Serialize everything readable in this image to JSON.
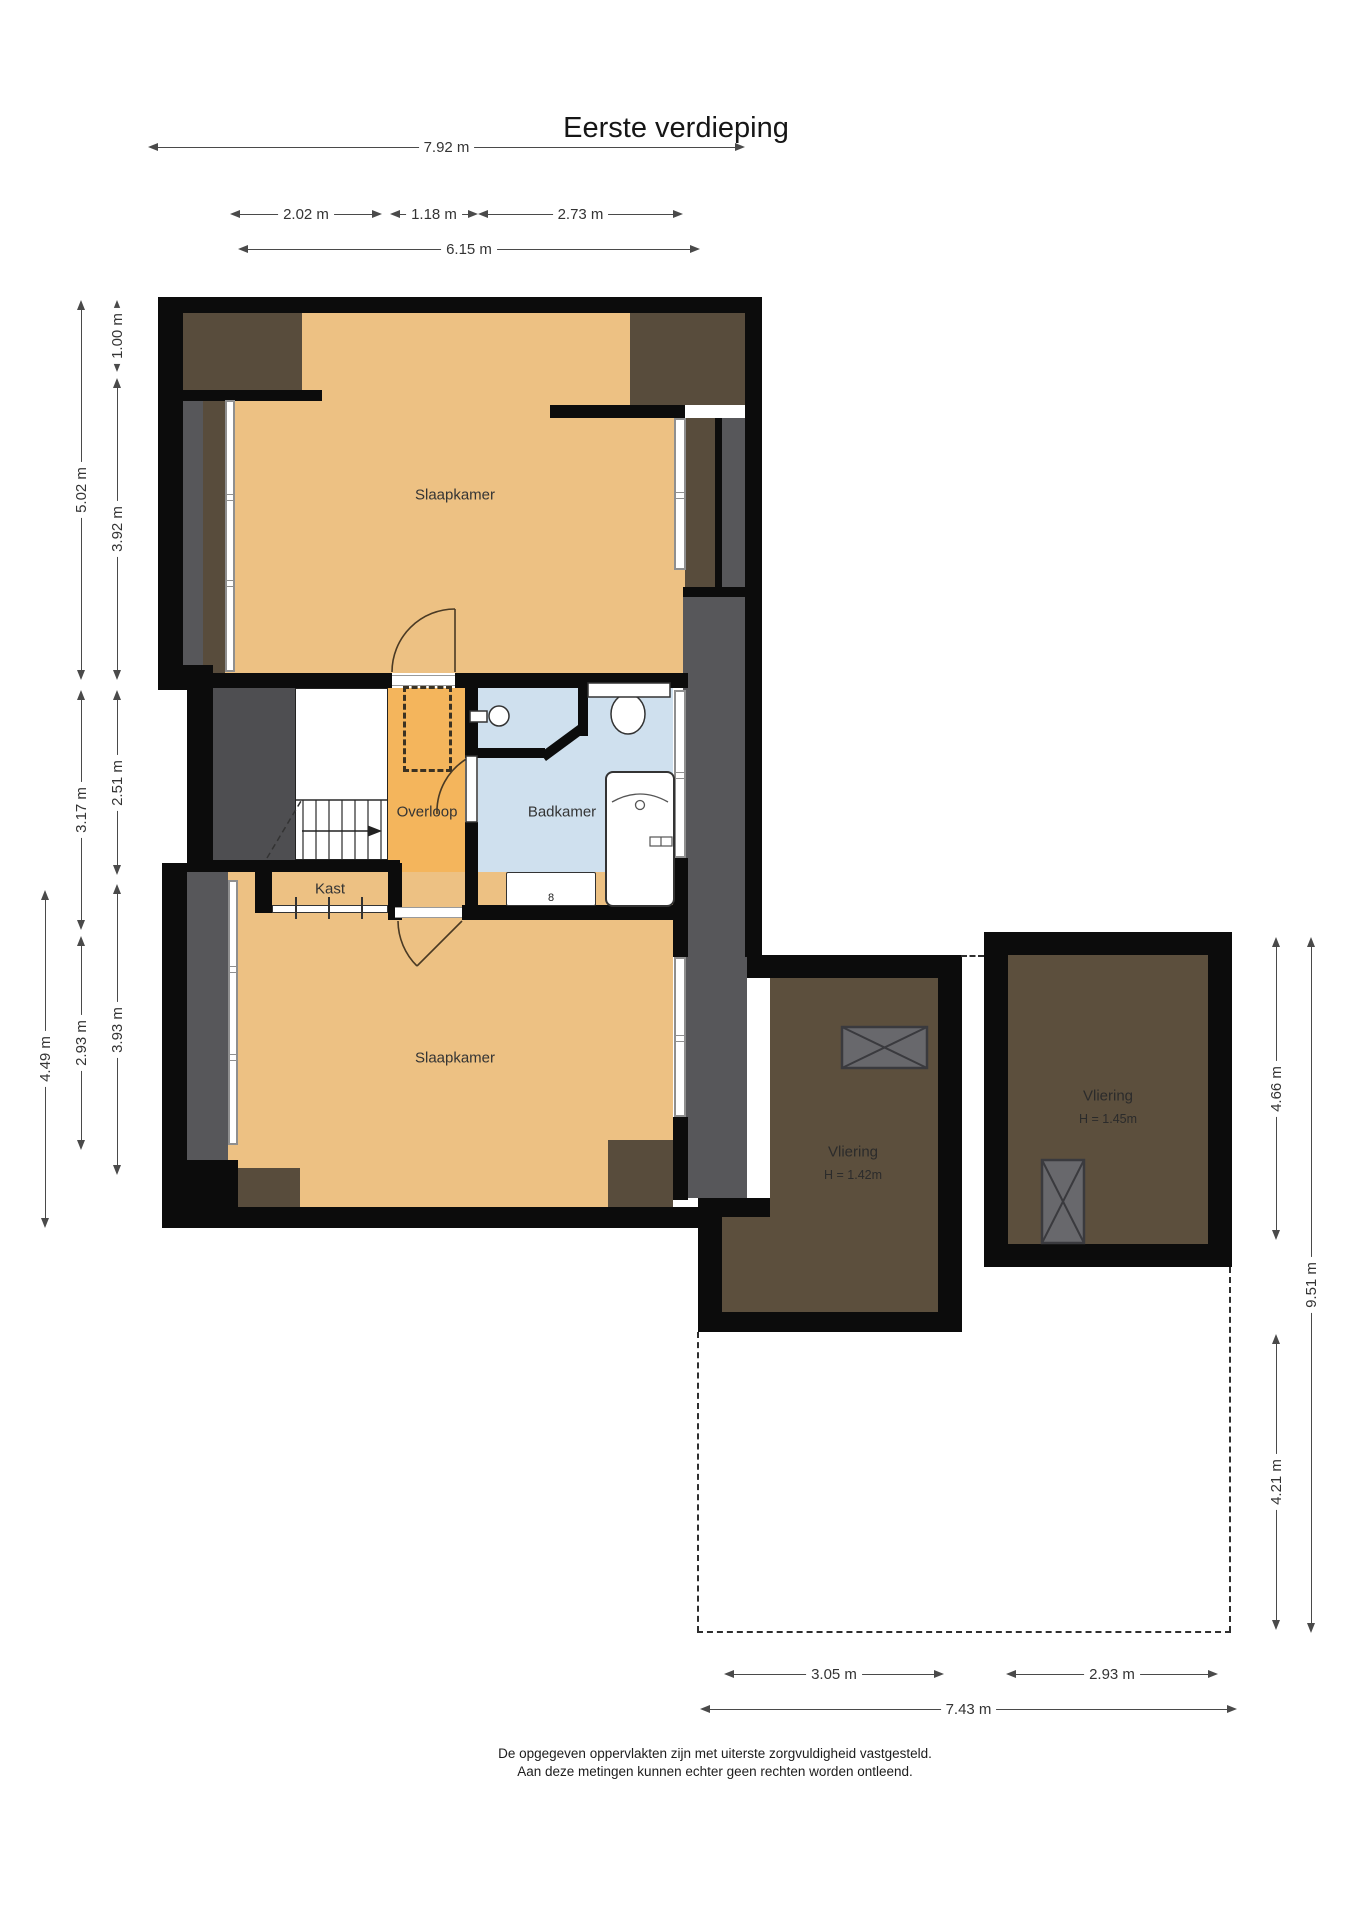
{
  "title": "Eerste verdieping",
  "rooms": {
    "slaapkamer_boven": {
      "label": "Slaapkamer"
    },
    "slaapkamer_onder": {
      "label": "Slaapkamer"
    },
    "overloop": {
      "label": "Overloop"
    },
    "badkamer": {
      "label": "Badkamer"
    },
    "kast": {
      "label": "Kast"
    },
    "vliering_links": {
      "label": "Vliering",
      "height_note": "H = 1.42m"
    },
    "vliering_rechts": {
      "label": "Vliering",
      "height_note": "H = 1.45m"
    }
  },
  "fixtures": {
    "radiator_symbol": "8"
  },
  "dims": {
    "top": [
      {
        "label": "7.92 m"
      },
      {
        "label": "2.02 m"
      },
      {
        "label": "1.18 m"
      },
      {
        "label": "2.73 m"
      },
      {
        "label": "6.15 m"
      }
    ],
    "left": [
      {
        "label": "1.00 m"
      },
      {
        "label": "3.92 m"
      },
      {
        "label": "2.51 m"
      },
      {
        "label": "3.93 m"
      },
      {
        "label": "5.02 m"
      },
      {
        "label": "3.17 m"
      },
      {
        "label": "2.93 m"
      },
      {
        "label": "4.49 m"
      }
    ],
    "right": [
      {
        "label": "4.66 m"
      },
      {
        "label": "4.21 m"
      },
      {
        "label": "9.51 m"
      }
    ],
    "bottom": [
      {
        "label": "3.05 m"
      },
      {
        "label": "2.93 m"
      },
      {
        "label": "7.43 m"
      }
    ]
  },
  "footer": {
    "line1": "De opgegeven oppervlakten zijn met uiterste zorgvuldigheid vastgesteld.",
    "line2": "Aan deze metingen kunnen echter geen rechten worden ontleend."
  },
  "colors": {
    "floor_bedroom": "#edc183",
    "floor_landing": "#f4b55c",
    "floor_bathroom": "#cfe0ee",
    "floor_closet": "#c9a56b",
    "roof_brown": "#584c3c",
    "attic_brown": "#5c4f3d",
    "zone_gray": "#57575a",
    "stair_gray": "#4e4e51",
    "wall": "#0c0c0c",
    "dim": "#4a4a4a"
  }
}
